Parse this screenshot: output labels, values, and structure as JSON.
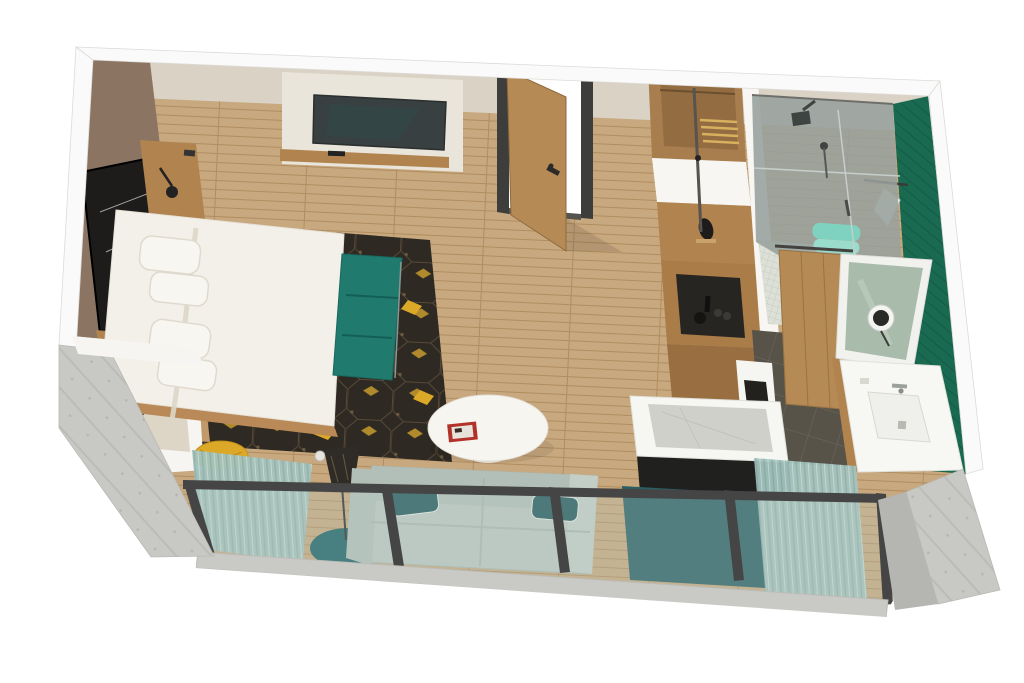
{
  "meta": {
    "type": "3d-floorplan-render",
    "subject": "Isometric cutaway 3D floor plan of a hotel studio suite",
    "canvas": {
      "width": 1024,
      "height": 683
    }
  },
  "palette": {
    "wall_white": "#fbfafa",
    "beige_wall": "#d9d2c5",
    "beige_inner": "#ddd5c6",
    "brown_wall": "#8b7462",
    "concrete": "#c8c8c5",
    "concrete_dark": "#b5b5b1",
    "wood_floor": "#c8a87e",
    "wood_furniture": "#b1834f",
    "wood_door": "#b58a55",
    "wood_closet": "#a87e4f",
    "bed_white": "#f3f0e9",
    "rug_dark": "#2e2922",
    "gold": "#dca827",
    "teal_bench": "#217a6e",
    "teal_dark": "#1d6166",
    "teal_wall": "#2b5f63",
    "sofa": "#bcc7c0",
    "sofa_pillow": "#24585c",
    "curtain": "#a3c2bd",
    "glass_tint": "#b9cfc9",
    "frame_dark": "#454545",
    "green_tile": "#1a6a52",
    "tile_dark": "#575349",
    "mosaic": "#dce0d7",
    "mirror_glass": "#a9bcab",
    "marble": "#d0d0cb",
    "tv_screen": "#394042",
    "tv_panel": "#eae5da",
    "near_black": "#1e1c1a",
    "red_book": "#b23128",
    "towel_teal": "#7fd2bf",
    "desk_base": "#20211f"
  },
  "scene": {
    "rooms": [
      {
        "name": "bedroom",
        "items": [
          "king-bed",
          "pillows",
          "headboard",
          "nightstand-top",
          "nightstand-bottom",
          "wall-art",
          "tv",
          "tv-shelf",
          "media-wall",
          "teal-bench",
          "patterned-rug",
          "yellow-stool",
          "floor-lamp",
          "round-rug",
          "window-ledge",
          "reading-lamps"
        ]
      },
      {
        "name": "living-area",
        "items": [
          "sofa",
          "throw-pillows",
          "oval-coffee-table",
          "red-book",
          "sheer-curtains",
          "glass-window-wall",
          "teal-accent-panel",
          "marble-top-desk"
        ]
      },
      {
        "name": "entry",
        "items": [
          "entry-door-open",
          "dark-door-frame",
          "wood-plank-floor"
        ]
      },
      {
        "name": "closet-wardrobe",
        "items": [
          "open-closet",
          "wardrobe-cabinet",
          "sculpture",
          "coffee-station-niche",
          "minibar-cabinet"
        ]
      },
      {
        "name": "bathroom",
        "items": [
          "walk-in-shower",
          "rain-shower-head",
          "hand-shower",
          "glass-screen",
          "mosaic-shower-floor",
          "green-tile-wall",
          "towel-stack",
          "towel-ring",
          "sliding-wood-door",
          "lit-mirror",
          "magnifying-mirror",
          "vanity-sink",
          "faucet",
          "dark-tile-floor",
          "toilet-partition"
        ]
      },
      {
        "name": "exterior",
        "items": [
          "concrete-corner-walls",
          "window-sill-slab"
        ]
      }
    ]
  }
}
